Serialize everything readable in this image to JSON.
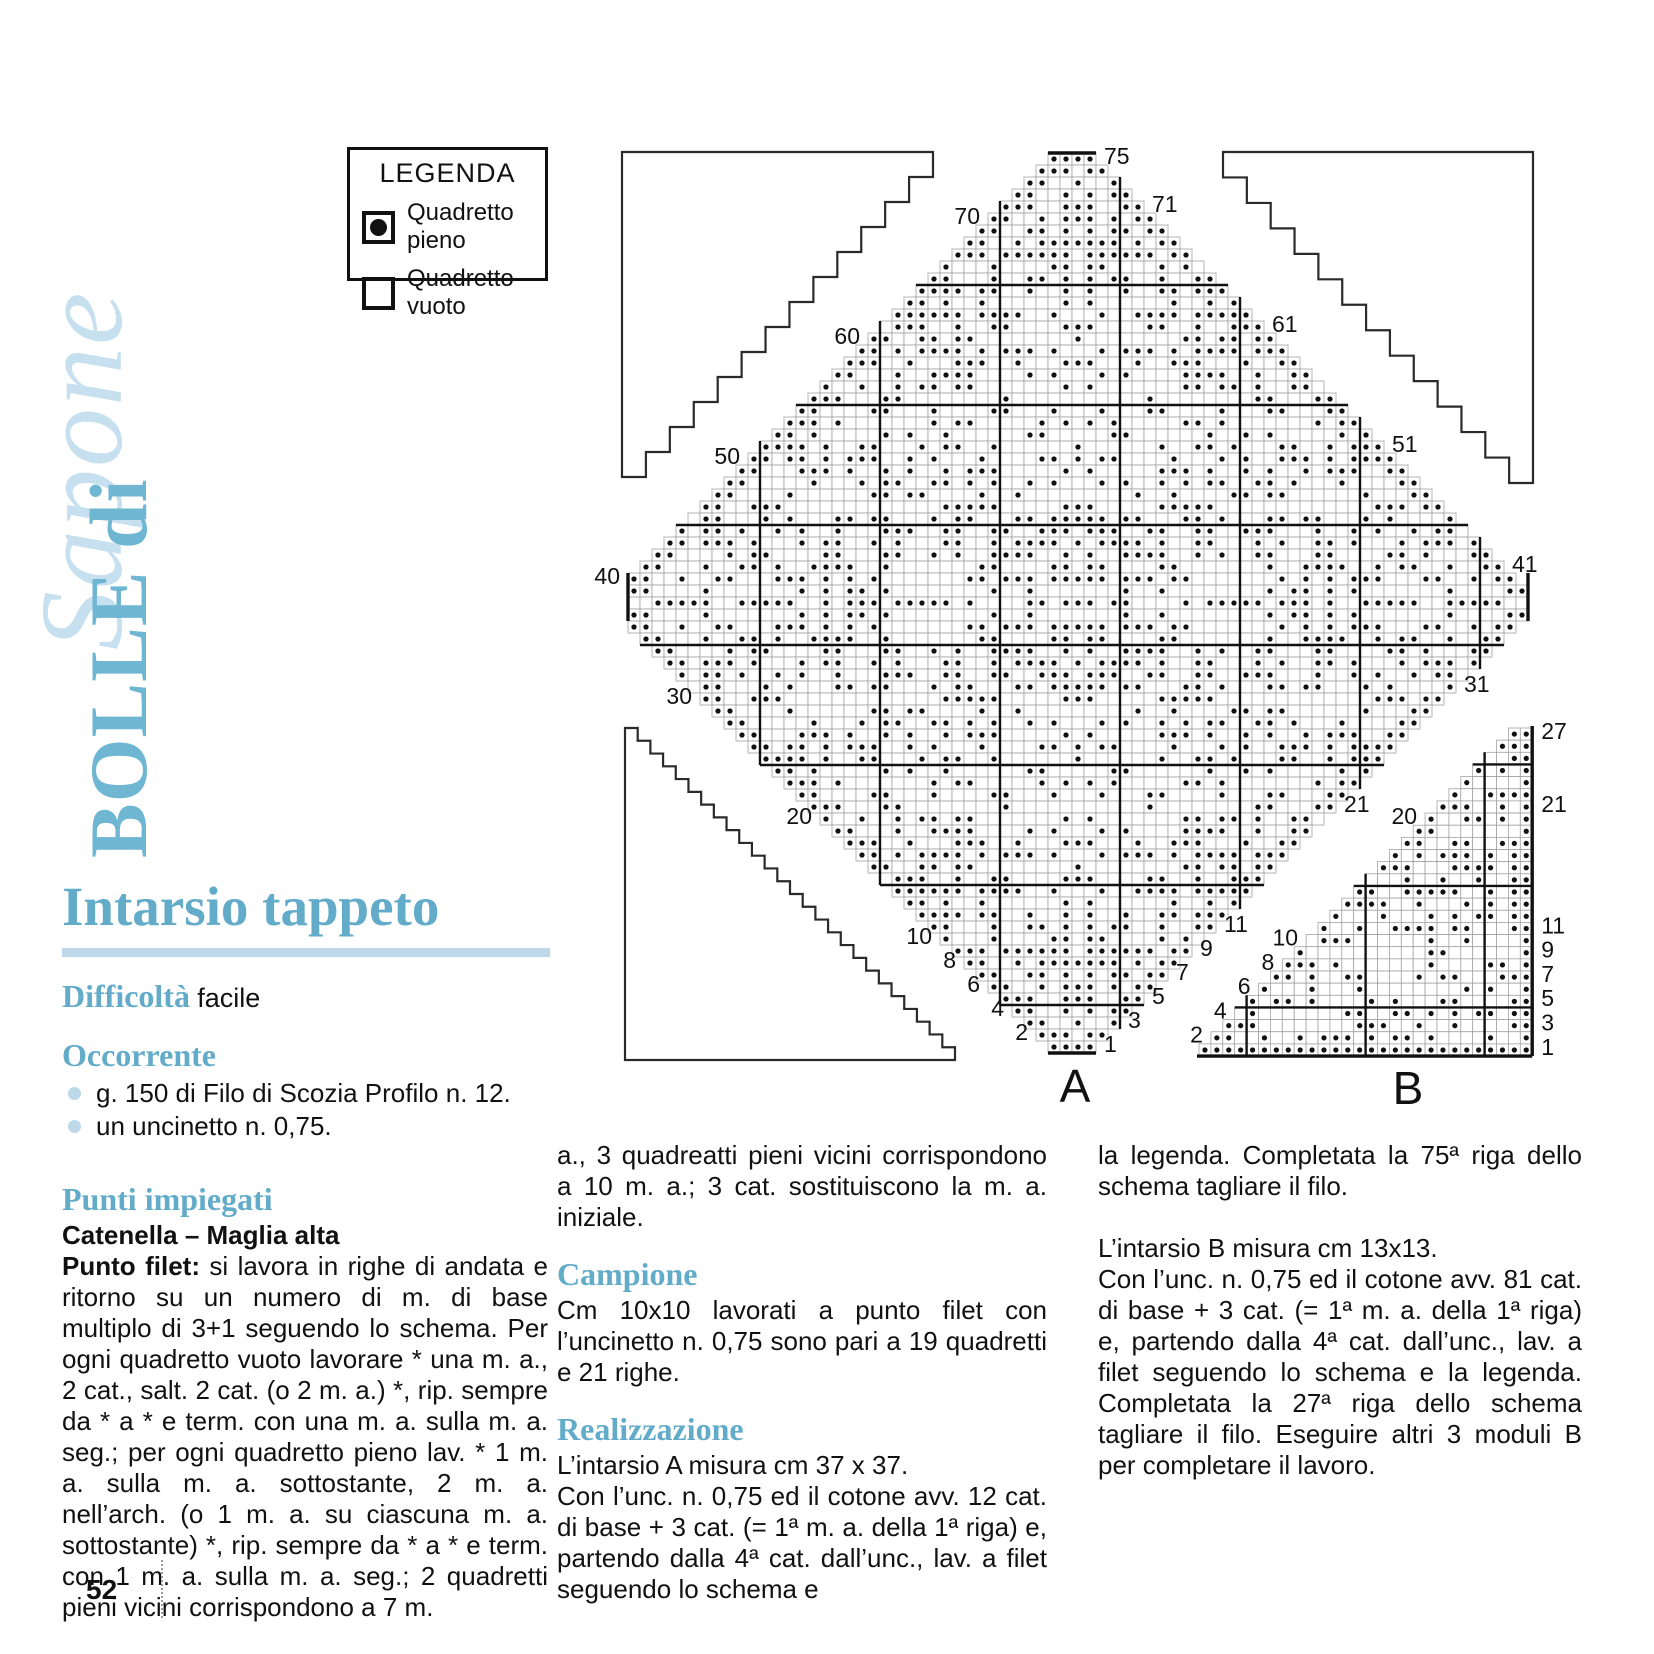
{
  "page": {
    "number": "52"
  },
  "masthead": {
    "title_script": "Sapone",
    "title_main": "BOLLE di"
  },
  "legend": {
    "title": "LEGENDA",
    "items": [
      {
        "symbol": "filled-square",
        "label": "Quadretto pieno"
      },
      {
        "symbol": "empty-square",
        "label": "Quadretto vuoto"
      }
    ]
  },
  "article": {
    "title": "Intarsio tappeto",
    "difficulty_label": "Difficoltà",
    "difficulty_value": "facile",
    "occorrente": {
      "heading": "Occorrente",
      "items": [
        "g. 150 di Filo di Scozia Profilo n. 12.",
        "un uncinetto n. 0,75."
      ]
    },
    "punti": {
      "heading": "Punti impiegati",
      "subheading": "Catenella – Maglia alta",
      "lead": "Punto filet:",
      "body": " si lavora in righe di andata e ritorno su un numero di m. di base multiplo di 3+1 seguendo lo schema. Per ogni quadretto vuoto lavorare * una m. a., 2 cat., salt. 2 cat. (o 2 m. a.) *, rip. sempre da * a * e term. con una m. a. sulla m. a. seg.; per ogni quadretto pieno lav. * 1 m. a. sulla m. a. sottostante, 2 m. a. nell’arch. (o 1 m. a. su ciascuna m. a. sottostante) *, rip. sempre da * a * e term. con 1 m. a. sulla m. a. seg.; 2 quadretti pieni vicini corrispondono a 7 m."
    },
    "continuation": "a., 3 quadreatti pieni vicini corrispondono a 10 m. a.; 3 cat. sostituiscono la m. a. iniziale.",
    "campione": {
      "heading": "Campione",
      "body": "Cm 10x10 lavorati a punto filet con l’uncinetto n. 0,75 sono pari a 19 quadretti e 21 righe."
    },
    "realizzazione": {
      "heading": "Realizzazione",
      "p1": "L’intarsio A misura cm 37 x 37.",
      "p2": "Con l’unc. n. 0,75 ed il cotone avv. 12 cat. di base + 3 cat. (= 1ª m. a. della 1ª riga) e, partendo dalla 4ª cat. dall’unc., lav. a filet seguendo lo schema e",
      "col3_p1": "la legenda. Completata la 75ª riga dello schema tagliare il filo.",
      "col3_p2": "L’intarsio B misura cm 13x13.",
      "col3_p3": "Con l’unc. n. 0,75 ed il cotone avv. 81 cat. di base + 3 cat. (= 1ª m. a. della 1ª riga) e, partendo dalla 4ª cat. dall’unc., lav. a filet seguendo lo schema e la legenda. Completata la 27ª riga dello schema tagliare il filo. Eseguire altri 3 moduli B per completare il lavoro."
    }
  },
  "charts": {
    "chart_a": {
      "label": "A",
      "type": "filet-diamond",
      "rows": 75,
      "tip_cells": 4,
      "x": 628,
      "y": 153,
      "cell": 12,
      "bold_boundaries": [
        11,
        21,
        31,
        41,
        51,
        61,
        71
      ],
      "left_labels": [
        70,
        60,
        50,
        40,
        30,
        20,
        10,
        8,
        6,
        4,
        2
      ],
      "right_labels": [
        75,
        71,
        61,
        51,
        41,
        31,
        21,
        11,
        9,
        7,
        5,
        3,
        1
      ],
      "seed": 3,
      "fill_ratio": 0.42,
      "label_x": 1075,
      "label_y": 1102
    },
    "chart_b": {
      "label": "B",
      "type": "filet-triangle",
      "rows": 27,
      "cols": 28,
      "x": 1199,
      "y": 728,
      "cell_x": 11.9,
      "cell_y": 12.15,
      "bold_rows_from_bottom": [
        4,
        14,
        24
      ],
      "bold_cols_from_right": [
        4,
        14,
        24
      ],
      "left_labels": [
        20,
        10,
        8,
        6,
        4,
        2
      ],
      "right_labels": [
        27,
        21,
        11,
        9,
        7,
        5,
        3,
        1
      ],
      "seed": 8,
      "fill_ratio": 0.4,
      "label_x": 1408,
      "label_y": 1104
    },
    "corner_outlines": [
      {
        "id": "top-left",
        "dir": "tl",
        "x": 622,
        "y": 152,
        "w": 311,
        "h": 325,
        "steps": 13
      },
      {
        "id": "top-right",
        "dir": "tr",
        "x": 1223,
        "y": 152,
        "w": 310,
        "h": 331,
        "steps": 13
      },
      {
        "id": "bottom-left",
        "dir": "bl",
        "x": 625,
        "y": 728,
        "w": 330,
        "h": 332,
        "steps": 26
      }
    ]
  },
  "colors": {
    "heading_blue": "#62abc9",
    "masthead_blue": "#6fb6d2",
    "script_blue": "#c6e0ef",
    "pale_bar": "#bdd9e9",
    "grid_line": "#9d9d9d",
    "ink": "#111111"
  }
}
